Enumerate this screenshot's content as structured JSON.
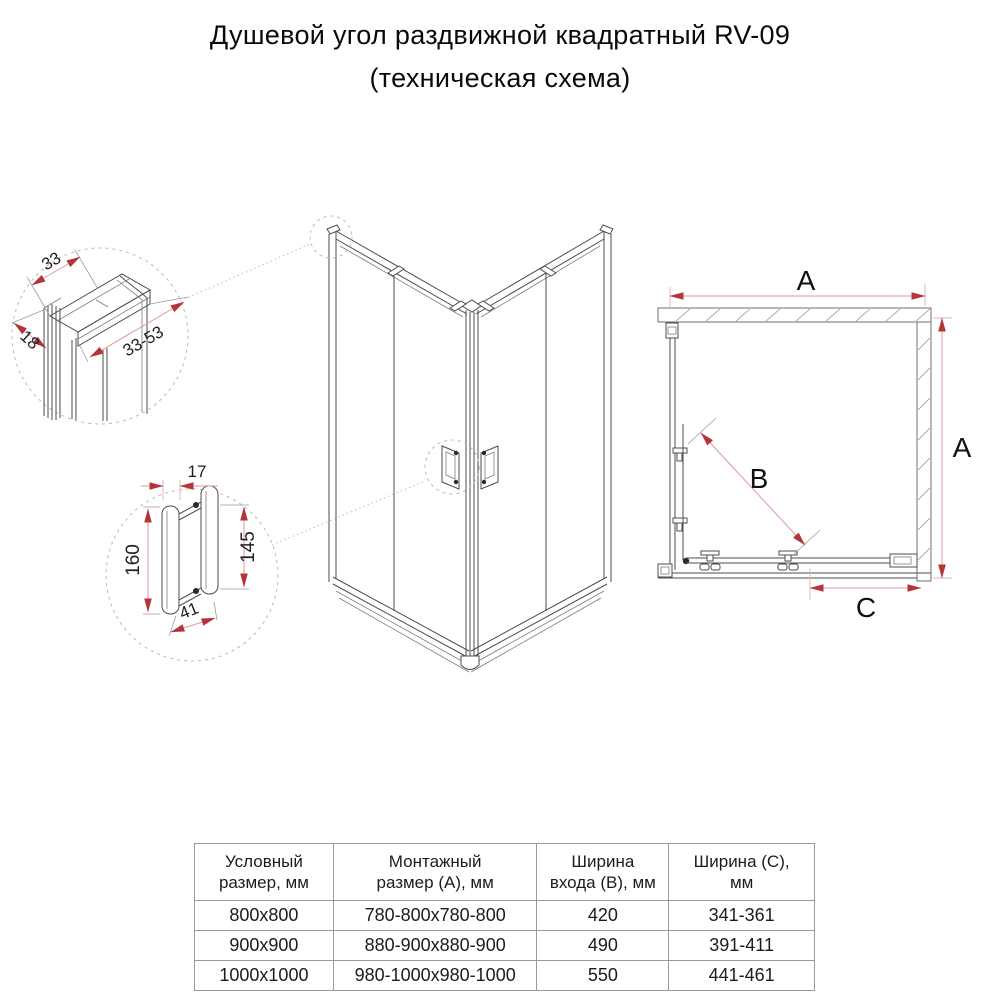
{
  "title": {
    "line1": "Душевой угол раздвижной квадратный RV-09",
    "line2": "(техническая схема)"
  },
  "diagram": {
    "profile_detail": {
      "dim_top": "33",
      "dim_side": "18",
      "dim_range": "33-53"
    },
    "handle_detail": {
      "dim_width": "17",
      "dim_outer_height": "160",
      "dim_inner_height": "145",
      "dim_bottom": "41"
    },
    "plan_view": {
      "dim_width_label": "A",
      "dim_depth_label": "A",
      "dim_entry_label": "B",
      "dim_door_label": "C"
    }
  },
  "table": {
    "headers": [
      {
        "line1": "Условный",
        "line2": "размер, мм"
      },
      {
        "line1": "Монтажный",
        "line2": "размер (А), мм"
      },
      {
        "line1": "Ширина",
        "line2": "входа (В), мм"
      },
      {
        "line1": "Ширина (С),",
        "line2": "мм"
      }
    ],
    "rows": [
      [
        "800x800",
        "780-800x780-800",
        "420",
        "341-361"
      ],
      [
        "900x900",
        "880-900x880-900",
        "490",
        "391-411"
      ],
      [
        "1000x1000",
        "980-1000x980-1000",
        "550",
        "441-461"
      ]
    ]
  },
  "colors": {
    "dimension_arrow_red": "#b5333a",
    "dimension_line_red": "#dc9a9a",
    "drawing_line_gray": "#4d4d4d",
    "table_border_gray": "#9a9a9a"
  }
}
